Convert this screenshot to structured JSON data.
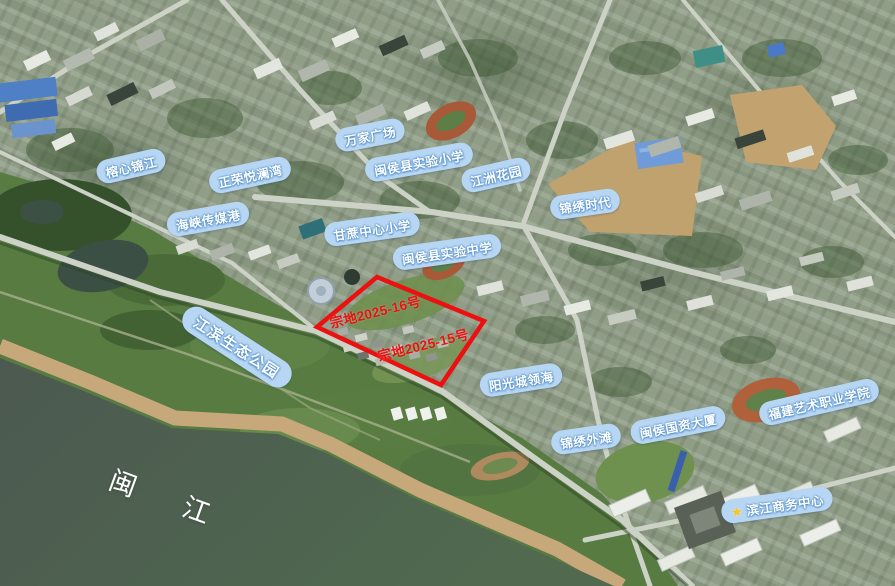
{
  "map": {
    "kind": "annotated-satellite-map",
    "river_label": {
      "text": "闽　江",
      "x": 166,
      "y": 497,
      "rotation": 20
    },
    "poi_labels": [
      {
        "text": "榕心锦江",
        "x": 131,
        "y": 166,
        "rotation": -13
      },
      {
        "text": "正荣悦澜湾",
        "x": 250,
        "y": 175,
        "rotation": -12
      },
      {
        "text": "海峡传媒港",
        "x": 208,
        "y": 219,
        "rotation": -10
      },
      {
        "text": "万家广场",
        "x": 370,
        "y": 135,
        "rotation": -11
      },
      {
        "text": "闽侯县实验小学",
        "x": 419,
        "y": 162,
        "rotation": -10
      },
      {
        "text": "江洲花园",
        "x": 496,
        "y": 175,
        "rotation": -13
      },
      {
        "text": "锦绣时代",
        "x": 585,
        "y": 204,
        "rotation": -8
      },
      {
        "text": "甘蔗中心小学",
        "x": 372,
        "y": 229,
        "rotation": -8
      },
      {
        "text": "闽侯县实验中学",
        "x": 447,
        "y": 252,
        "rotation": -8
      },
      {
        "text": "江滨生态公园",
        "x": 237,
        "y": 347,
        "rotation": 33,
        "style": "large"
      },
      {
        "text": "阳光城领海",
        "x": 521,
        "y": 380,
        "rotation": -9
      },
      {
        "text": "锦绣外滩",
        "x": 586,
        "y": 439,
        "rotation": -8
      },
      {
        "text": "闽侯国资大厦",
        "x": 678,
        "y": 425,
        "rotation": -11
      },
      {
        "text": "福建艺术职业学院",
        "x": 819,
        "y": 402,
        "rotation": -13
      },
      {
        "text": "滨江商务中心",
        "x": 777,
        "y": 505,
        "rotation": -8,
        "icon": "star"
      }
    ],
    "parcels": {
      "outline_color": "#ec1111",
      "labels": [
        {
          "text": "宗地2025-16号",
          "x": 375,
          "y": 311,
          "rotation": -14
        },
        {
          "text": "宗地2025-15号",
          "x": 423,
          "y": 344,
          "rotation": -14
        }
      ]
    }
  },
  "colors": {
    "label_pill_bg": "#b7d6f3",
    "label_text": "#ffffff",
    "label_outline": "#4f8cc9",
    "parcel_red": "#ec1111",
    "star_gold": "#f5c529",
    "river": "#4d5a51",
    "park_green": "#577b41",
    "sand": "#c7a87a"
  }
}
